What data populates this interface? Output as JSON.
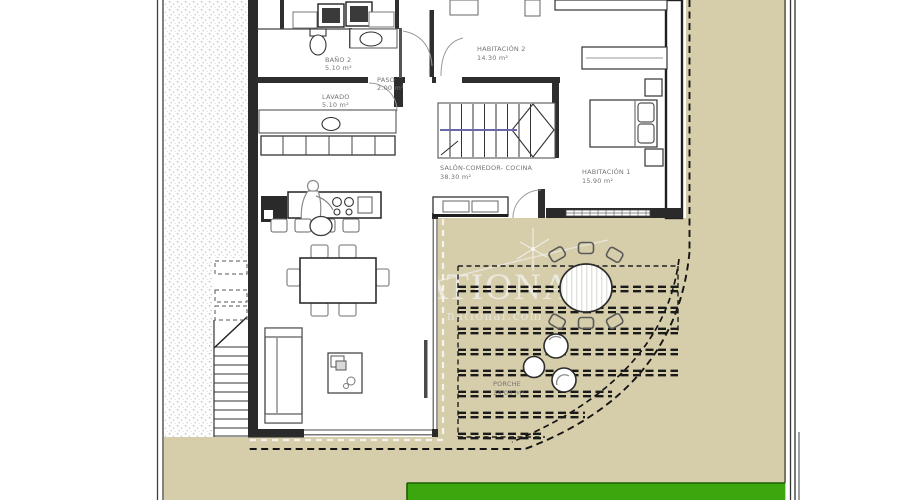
{
  "plan": {
    "title": "floor-plan",
    "rooms": [
      {
        "name": "BAÑO 2",
        "area": "5.10 m²"
      },
      {
        "name": "LAVADO",
        "area": "5.10 m²"
      },
      {
        "name": "PASO",
        "area": "2.00 m²"
      },
      {
        "name": "HABITACIÓN 2",
        "area": "14.30 m²"
      },
      {
        "name": "SALÓN-COMEDOR- COCINA",
        "area": "38.30 m²"
      },
      {
        "name": "HABITACIÓN 1",
        "area": "15.90 m²"
      },
      {
        "name": "PORCHE",
        "area": "34.00 m²"
      }
    ],
    "watermark": {
      "brand": "NATIONAL",
      "domain": "national.com"
    },
    "colors": {
      "ground": "#d6cdaa",
      "grass": "#3ca60f",
      "wall": "#232323",
      "gray_line": "#8a8a8a",
      "stair_rail": "#6a6aa8",
      "label": "#757575"
    }
  }
}
